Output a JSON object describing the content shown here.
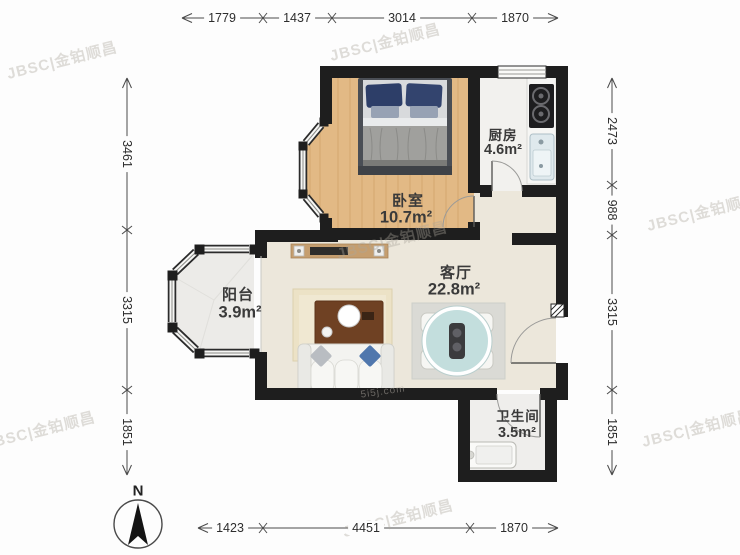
{
  "plan": {
    "rooms": [
      {
        "name": "卧室",
        "area": "10.7m²"
      },
      {
        "name": "厨房",
        "area": "4.6m²"
      },
      {
        "name": "客厅",
        "area": "22.8m²"
      },
      {
        "name": "阳台",
        "area": "3.9m²"
      },
      {
        "name": "卫生间",
        "area": "3.5m²"
      }
    ]
  },
  "dimensions": {
    "top": [
      "1779",
      "1437",
      "3014",
      "1870"
    ],
    "bottom": [
      "1423",
      "4451",
      "1870"
    ],
    "left": [
      "3461",
      "3315",
      "1851"
    ],
    "right": [
      "2473",
      "988",
      "3315",
      "1851"
    ]
  },
  "compass": {
    "label": "N"
  },
  "watermark": {
    "text": "JBSC|金铂顺昌",
    "secondary": "5i5j.com"
  },
  "colors": {
    "wall": "#1e1e1e",
    "wood_floor": "#e2b985",
    "living_floor": "#ece7db",
    "balcony_floor": "#ecebe8",
    "dining_table": "#c3dedd",
    "sofa_pillow": "#5077ad"
  }
}
